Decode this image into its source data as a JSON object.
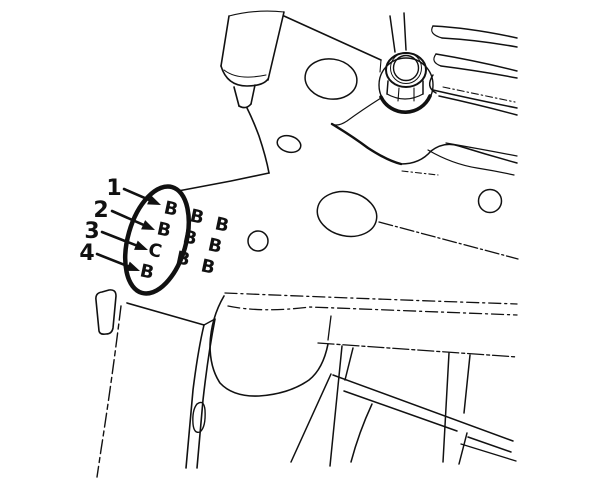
{
  "stamp_grid": {
    "rows": [
      [
        "B",
        "B",
        "B"
      ],
      [
        "B",
        "B",
        "B"
      ],
      [
        "C",
        "B",
        "B"
      ],
      [
        "B"
      ]
    ]
  },
  "callouts": [
    {
      "number": "1",
      "letter": "B"
    },
    {
      "number": "2",
      "letter": "B"
    },
    {
      "number": "3",
      "letter": "C"
    },
    {
      "number": "4",
      "letter": "B"
    }
  ],
  "colors": {
    "ink": "#111111",
    "background": "#ffffff"
  }
}
